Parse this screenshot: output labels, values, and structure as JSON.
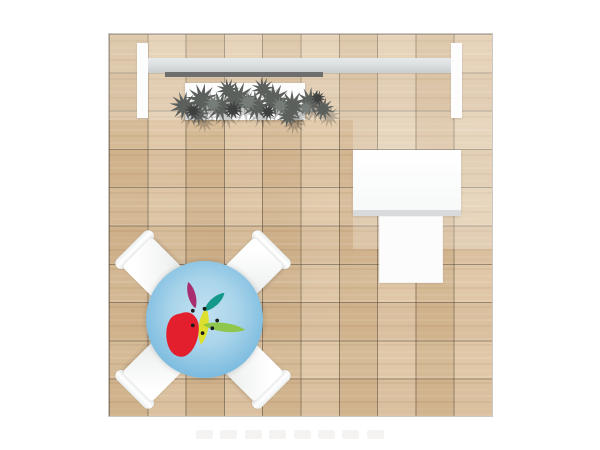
{
  "scene": {
    "description": "Top-down rendering of a square trade-show booth on a wood tile floor",
    "background_color": "#ffffff",
    "floor": {
      "label": "wood-tile-floor",
      "base_color": "#d8bc97",
      "grid_color": "#54483a",
      "tiles": "10x10"
    },
    "back_wall": {
      "label": "back-wall-with-shelf",
      "endcap_color": "#fdfdfd",
      "beam_color": "#dde1e2",
      "shelf_bar_color": "#6e6e6e",
      "planter_color": "#fcfcfc"
    },
    "plant": {
      "label": "spiky-foliage-plant",
      "foliage_color": "#5c605d",
      "foliage_light": "#767c77",
      "foliage_dark": "#3d403e",
      "shadow_color": "rgba(0,0,0,0.20)"
    },
    "desk": {
      "label": "reception-counter",
      "body_color": "#fafbfb",
      "edge_color": "#d8dadb"
    },
    "stool": {
      "label": "stool-or-chair",
      "color": "#fcfcfc"
    },
    "meeting_table": {
      "label": "round-meeting-table",
      "top_center_color": "#c2e1f1",
      "top_edge_color": "#5ea8d3"
    },
    "chairs": {
      "label": "white-chair",
      "count": 4,
      "color": "#ffffff"
    },
    "logo": {
      "label": "fruit-and-leaves-logo",
      "colors": {
        "red": "#e31e2d",
        "yellow": "#dde02e",
        "green": "#8cc63e",
        "teal": "#13988a",
        "magenta": "#a92e70",
        "dots": "#1c1c1c"
      }
    },
    "canopy_overlay": {
      "label": "canopy-highlight",
      "color": "rgba(255,255,255,0.22)"
    },
    "watermark": {
      "label": "faint-thumbnail-row",
      "count": 8,
      "color": "#f4f3f1"
    }
  }
}
